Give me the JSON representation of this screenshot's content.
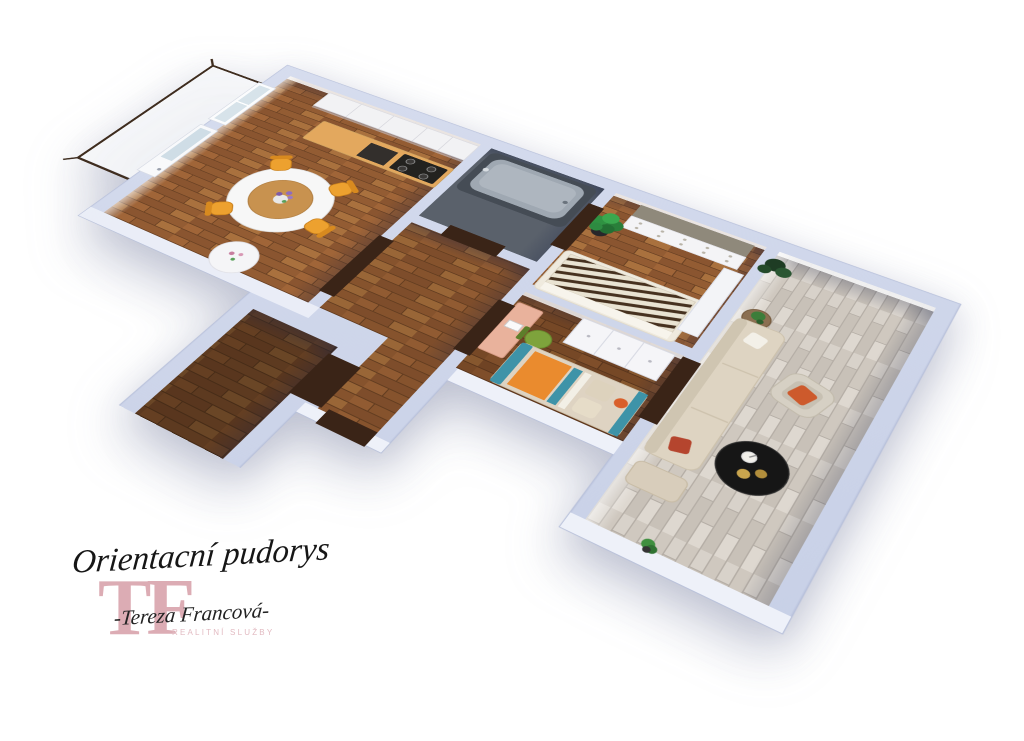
{
  "page": {
    "background_color": "#ffffff",
    "type": "3D apartment floor plan rendering"
  },
  "branding": {
    "plan_title": "Orientacní pudorys",
    "monogram": "TF",
    "agent_name": "-Tereza Francová-",
    "agent_subtitle": "REALITNÍ SLUŽBY",
    "monogram_color": "#dcacb4",
    "text_color": "#161616",
    "subtitle_color": "#e2bac1"
  },
  "floor_plan": {
    "view": "angled top-down 3D render on white background",
    "wall_color": "#ccd4e8",
    "door_color": "#3a2417",
    "colors": {
      "warm_wood_floor": "#9c6236",
      "light_wood_floor": "#d7d1c9",
      "balcony_railing": "#3f2d1f",
      "kitchen_counter_top": "#e3a85e",
      "dining_chair_orange": "#eda12f",
      "bathtub_grey": "#9fa8b2",
      "kids_bed_teal": "#3e93a8",
      "kids_bed_orange": "#ea8b2e",
      "sofa_beige": "#ded4c2",
      "armchair_pillow_orange": "#cd5a2c",
      "coffee_table_black": "#161616",
      "plant_green": "#2f9242"
    },
    "rooms": [
      {
        "name": "Balcony",
        "floor": "white",
        "features": [
          "dark brown railing"
        ]
      },
      {
        "name": "Kitchen and dining room",
        "floor": "warm wood",
        "features": [
          "white cabinet run",
          "orange counter with cooktop and oven",
          "round white dining table",
          "flower vase",
          "orange dining chairs",
          "small round side table",
          "window",
          "balcony door"
        ]
      },
      {
        "name": "Bathroom",
        "floor": "dark grey",
        "features": [
          "grey bathtub with faucet"
        ]
      },
      {
        "name": "Hall",
        "floor": "warm wood",
        "features": [
          "dark brown interior doors",
          "entry door"
        ]
      },
      {
        "name": "Storage WC room",
        "floor": "dark wood",
        "features": []
      },
      {
        "name": "Bedroom",
        "floor": "warm wood",
        "features": [
          "white chest of drawers with grey top",
          "potted green plant",
          "bed with zebra striped throw",
          "white wardrobe"
        ]
      },
      {
        "name": "Children's room",
        "floor": "dark wood",
        "features": [
          "salmon desk",
          "green chair",
          "white wardrobe",
          "bed with teal and orange bedding",
          "beige pillows"
        ]
      },
      {
        "name": "Living room",
        "floor": "light grey wood",
        "features": [
          "beige sofa",
          "white pillow",
          "red pillow",
          "ottoman",
          "grey armchair with orange pillow",
          "round black coffee table with candle and plates",
          "wooden side table with plant",
          "potted plants"
        ]
      }
    ]
  }
}
